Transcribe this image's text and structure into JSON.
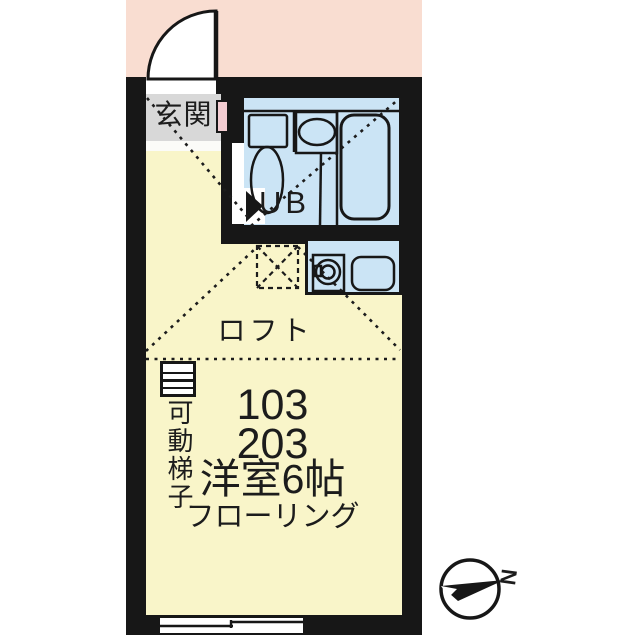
{
  "plan": {
    "entrance_label": "玄関",
    "unit_bath_label": "UB",
    "loft_label": "ロフト",
    "ladder_label": "可動梯子",
    "unit_numbers": [
      "103",
      "203"
    ],
    "room_type_label": "洋室6帖",
    "flooring_label": "フローリング",
    "compass_north_label": "N"
  },
  "colors": {
    "page_background": "#ffffff",
    "header_band": "#f9ddd1",
    "wall": "#171717",
    "room_floor": "#f9f5c9",
    "wet_area_floor": "#cbe4f5",
    "entrance_floor": "#d8d8d8",
    "door_panel": "#f4cdd2"
  }
}
